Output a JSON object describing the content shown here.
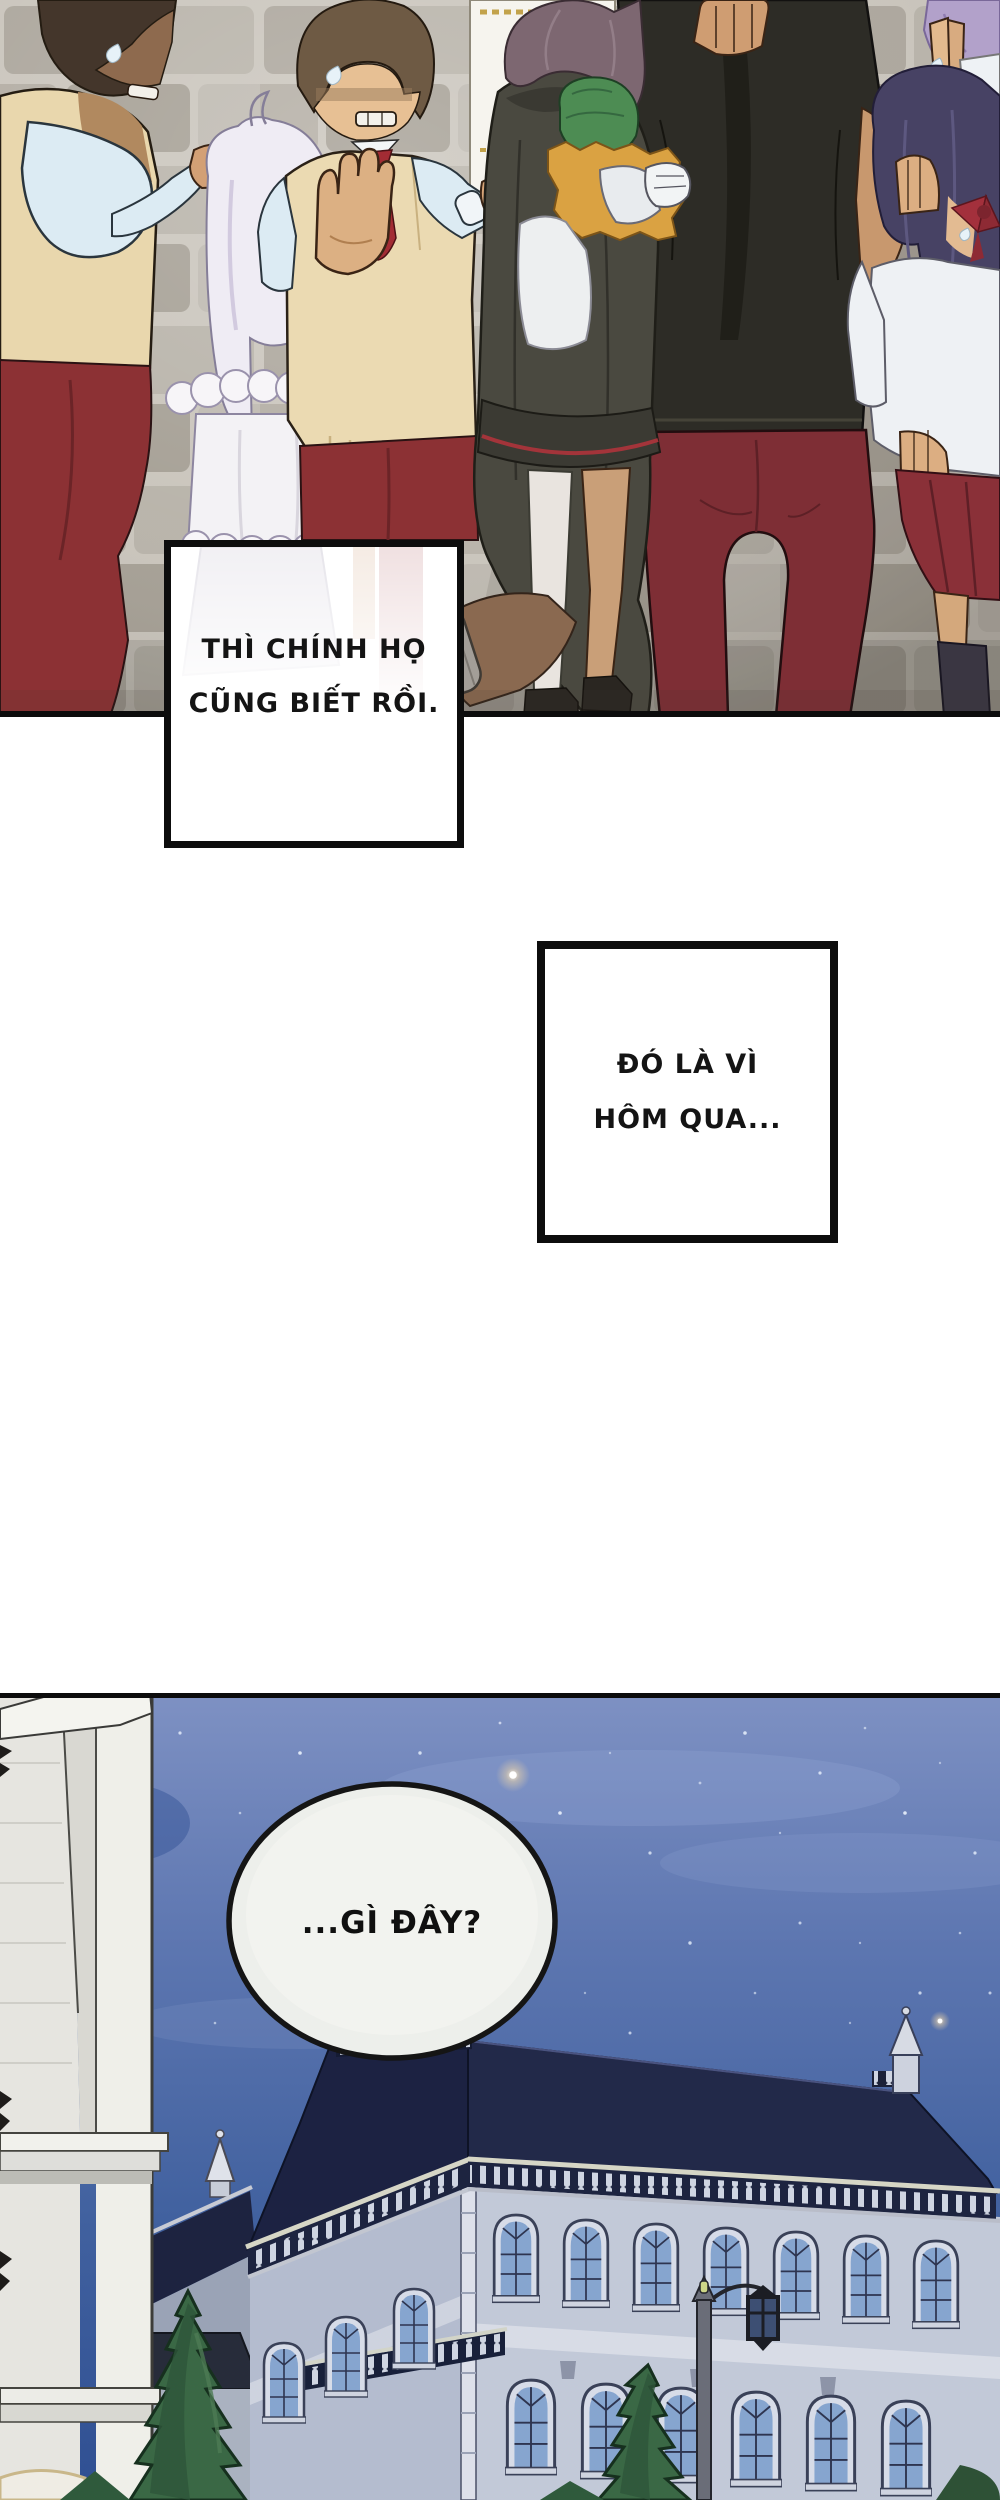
{
  "page": {
    "type": "webtoon comic page",
    "language": "Vietnamese",
    "background": "#ffffff"
  },
  "panels": {
    "crowd_scene": {
      "description": "Startled crowd in uniforms (tan vests, light blue shirts, red trousers and skirts) against a stone brick wall; a white-haired girl, a cloaked figure holding a green-haired child, a large man in a black shirt seen from behind, and shocked girls with purple and navy hair; a small notice poster hangs on the wall",
      "dialogue_box_1": {
        "line1": "THÌ CHÍNH HỌ",
        "line2": "CŨNG BIẾT RỒI."
      },
      "dialogue_box_2": {
        "line1": "ĐÓ LÀ VÌ",
        "line2": "HÔM QUA..."
      }
    },
    "palace_night": {
      "description": "Grand palace with a dark mansard roof, balustrades, arched windows, cypress trees and a street lamp under a starry night sky; a white stone tower stands in the left foreground",
      "speech_bubble": {
        "text": "...GÌ ĐÂY?"
      }
    }
  },
  "palette": {
    "panel_border": "#0d0d0d",
    "brick_light": "#c6c1b8",
    "brick_mid": "#aaa49a",
    "brick_dark": "#9b948a",
    "red_uniform": "#8c3134",
    "maroon_trousers": "#7e2e35",
    "tan_vest": "#ebdab2",
    "blue_shirt": "#dcebf3",
    "white_hair": "#efecf4",
    "green_hair": "#4d8c53",
    "orange_wrap": "#daa242",
    "cloak_gray": "#4a4940",
    "black_shirt": "#2d2c26",
    "navy_hair": "#474264",
    "purple_hair": "#b2a1ca",
    "night_sky_top": "#7e91c3",
    "night_sky_deep": "#2f4f92",
    "roof_navy": "#1c2242",
    "palace_wall": "#c2c9d8",
    "tower_white": "#e6e5e0",
    "tree_green": "#3a6845",
    "bubble_fill": "#edefeb"
  }
}
